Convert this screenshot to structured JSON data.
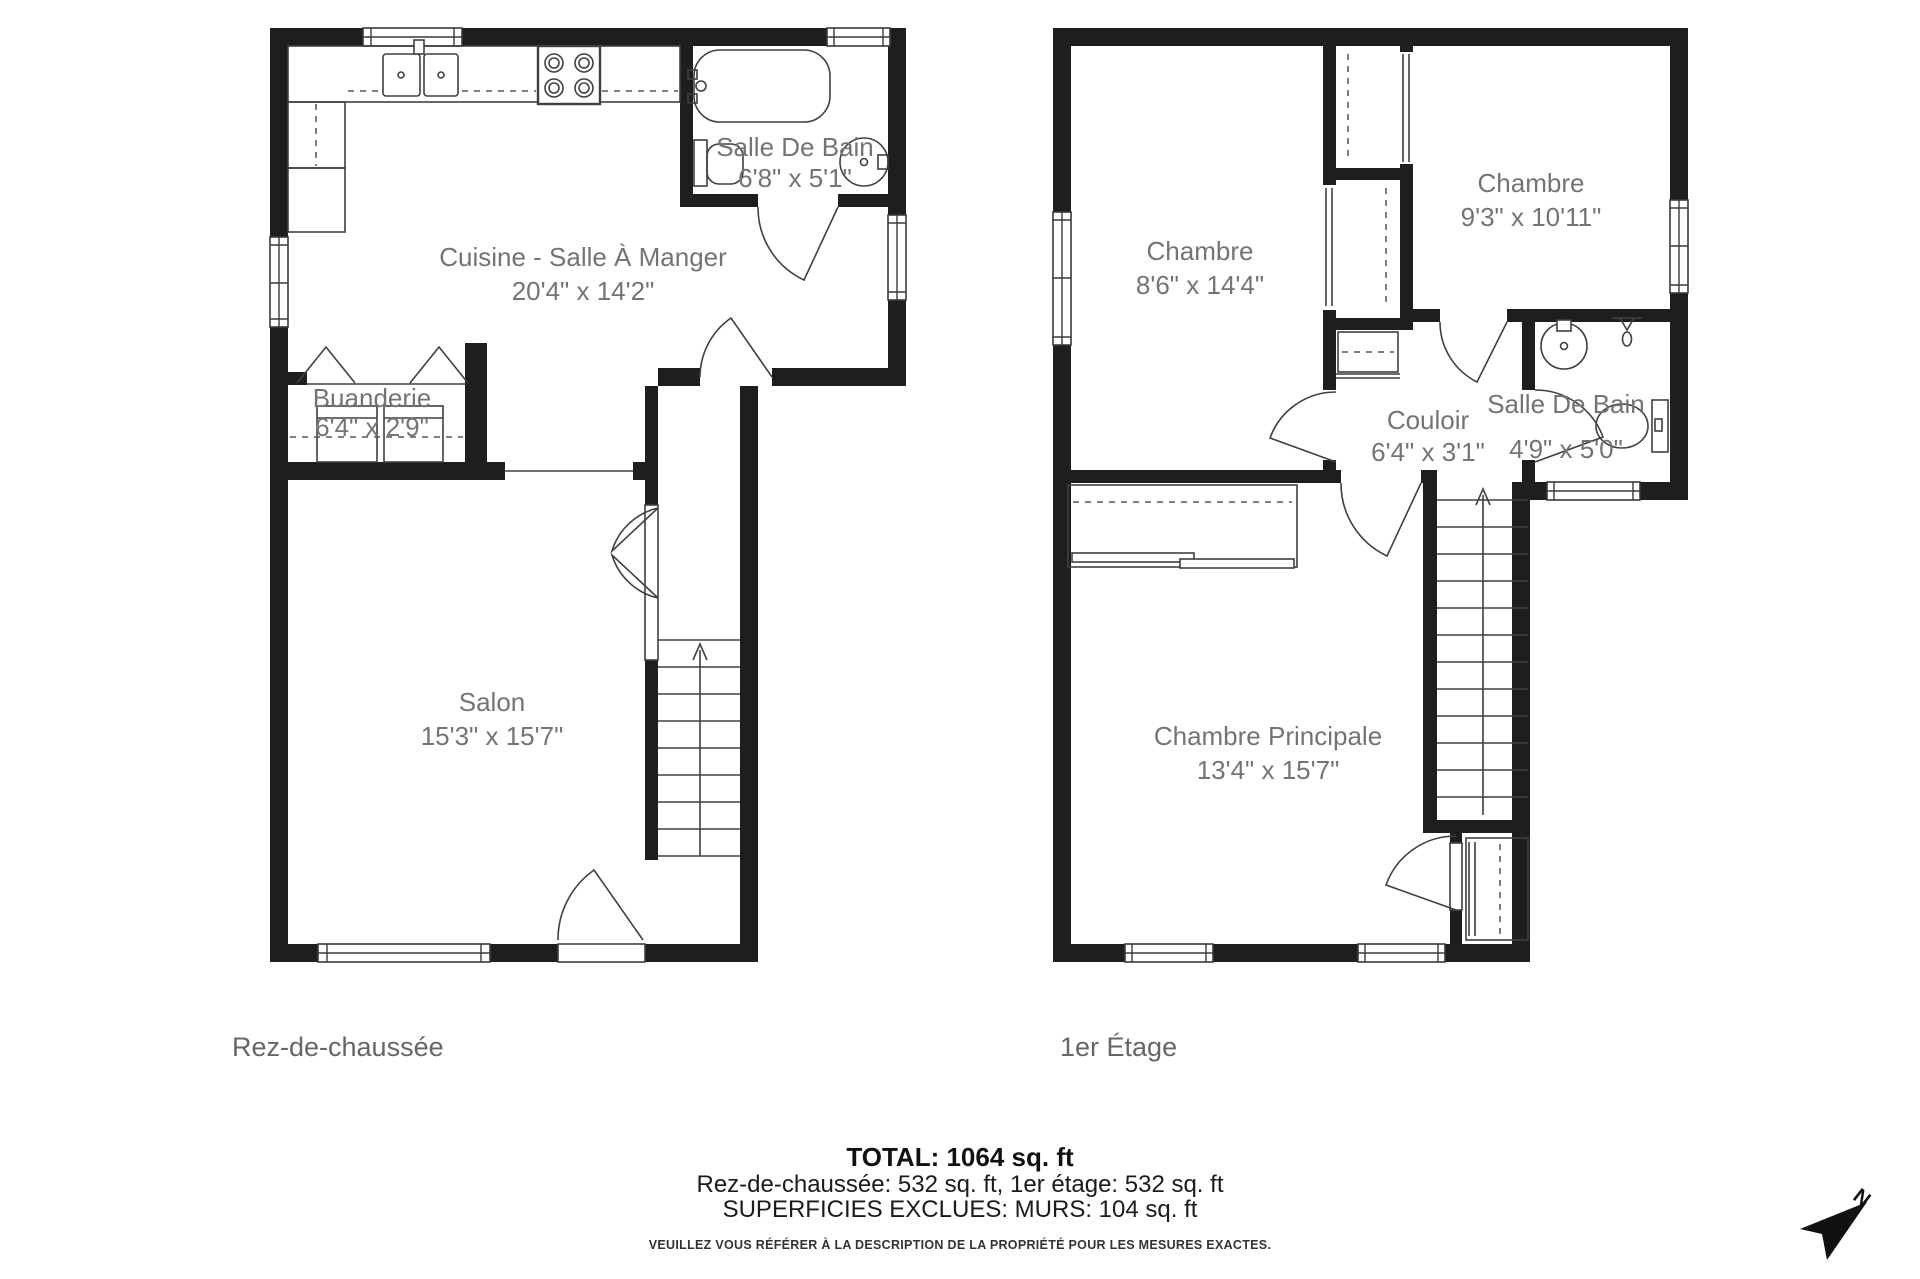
{
  "colors": {
    "wall": "#1e1e1e",
    "fixture_stroke": "#404040",
    "room_label": "#747474",
    "floor_label": "#666666",
    "footer_text": "#1b1b1b"
  },
  "floors": [
    {
      "label": "Rez-de-chaussée",
      "rooms": [
        {
          "name": "Cuisine - Salle À Manger",
          "dims": "20'4\" x 14'2\""
        },
        {
          "name": "Salle De Bain",
          "dims": "6'8\" x 5'1\""
        },
        {
          "name": "Buanderie",
          "dims": "6'4\" x 2'9\""
        },
        {
          "name": "Salon",
          "dims": "15'3\" x 15'7\""
        }
      ]
    },
    {
      "label": "1er Étage",
      "rooms": [
        {
          "name": "Chambre",
          "dims": "8'6\" x 14'4\""
        },
        {
          "name": "Chambre",
          "dims": "9'3\" x 10'11\""
        },
        {
          "name": "Couloir",
          "dims": "6'4\" x 3'1\""
        },
        {
          "name": "Salle De Bain",
          "dims": "4'9\" x 5'0\""
        },
        {
          "name": "Chambre Principale",
          "dims": "13'4\" x 15'7\""
        }
      ]
    }
  ],
  "footer": {
    "total": "TOTAL: 1064 sq. ft",
    "breakdown": "Rez-de-chaussée: 532 sq. ft, 1er étage: 532 sq. ft",
    "excluded": "SUPERFICIES EXCLUES: MURS: 104 sq. ft",
    "disclaimer": "VEUILLEZ VOUS RÉFÉRER À LA DESCRIPTION DE LA PROPRIÉTÉ POUR LES MESURES EXACTES."
  },
  "compass": {
    "label": "N"
  }
}
